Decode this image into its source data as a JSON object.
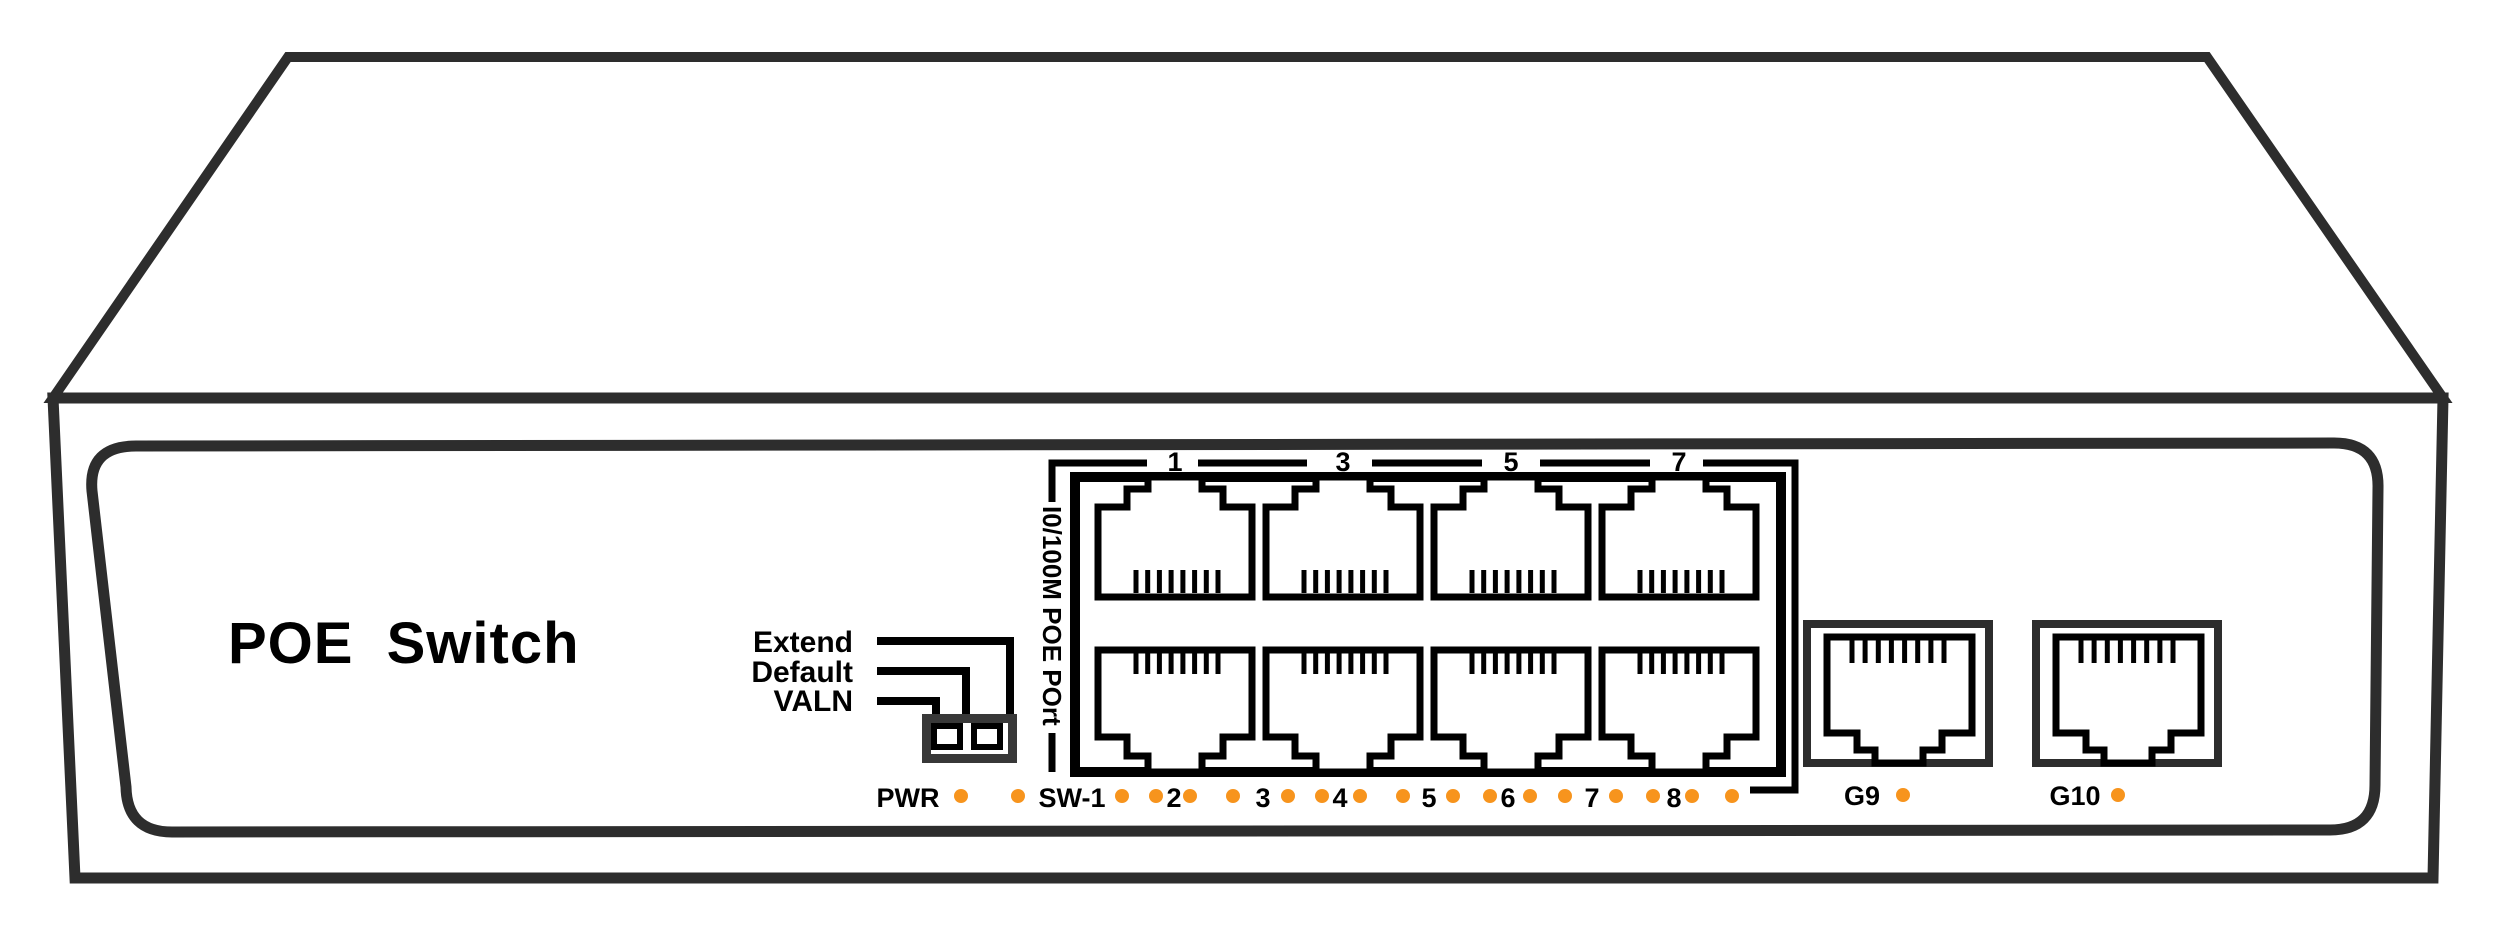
{
  "device": {
    "title": "POE Switch"
  },
  "config_switch": {
    "labels": [
      "Extend",
      "Default",
      "VALN"
    ]
  },
  "poe_ports": {
    "group_label": "I0/100M POE POrt",
    "top_row_numbers": [
      "1",
      "3",
      "5",
      "7"
    ],
    "count": 8
  },
  "status_leds": {
    "labels": [
      "PWR",
      "SW-1",
      "2",
      "3",
      "4",
      "5",
      "6",
      "7",
      "8"
    ]
  },
  "uplink_ports": {
    "labels": [
      "G9",
      "G10"
    ]
  },
  "colors": {
    "led_dot": "#F7941D",
    "detail_outline": "#000000",
    "chassis_outline": "#2D2D2D"
  }
}
